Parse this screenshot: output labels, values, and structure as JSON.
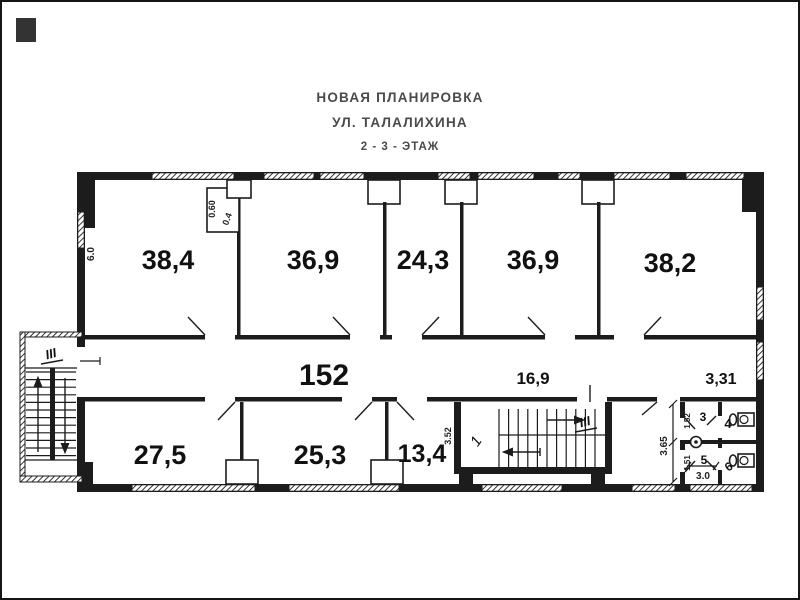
{
  "colors": {
    "ink": "#1c1c1c",
    "title_text": "#4a4a4a",
    "paper": "#ffffff"
  },
  "title": {
    "line1": "НОВАЯ ПЛАНИРОВКА",
    "line2": "УЛ. ТАЛАЛИХИНА",
    "line3": "2 - 3  - ЭТАЖ"
  },
  "plan": {
    "rooms_top": [
      {
        "area": "38,4"
      },
      {
        "area": "36,9"
      },
      {
        "area": "24,3"
      },
      {
        "area": "36,9"
      },
      {
        "area": "38,2"
      }
    ],
    "rooms_bottom": [
      {
        "area": "27,5"
      },
      {
        "area": "25,3"
      },
      {
        "area": "13,4"
      }
    ],
    "corridor_area": "152",
    "stair_hall_area": "16,9",
    "wc_hall_area": "3,31",
    "wc_cells": {
      "top_left": "3",
      "top_right": "4",
      "bottom_left": "5",
      "bottom_right": "6"
    },
    "stairs": {
      "left_label": "III",
      "mid_label": "III",
      "mid_landing": "1"
    },
    "dims": {
      "room1_left": "6.0",
      "closet_depth": "0.60",
      "closet_width": "0.4",
      "stair_bay": "3.52",
      "wc_depth": "3.65",
      "wc_stall_top": "1.52",
      "wc_stall_bottom": "1.51",
      "wc_width": "3.0"
    }
  }
}
